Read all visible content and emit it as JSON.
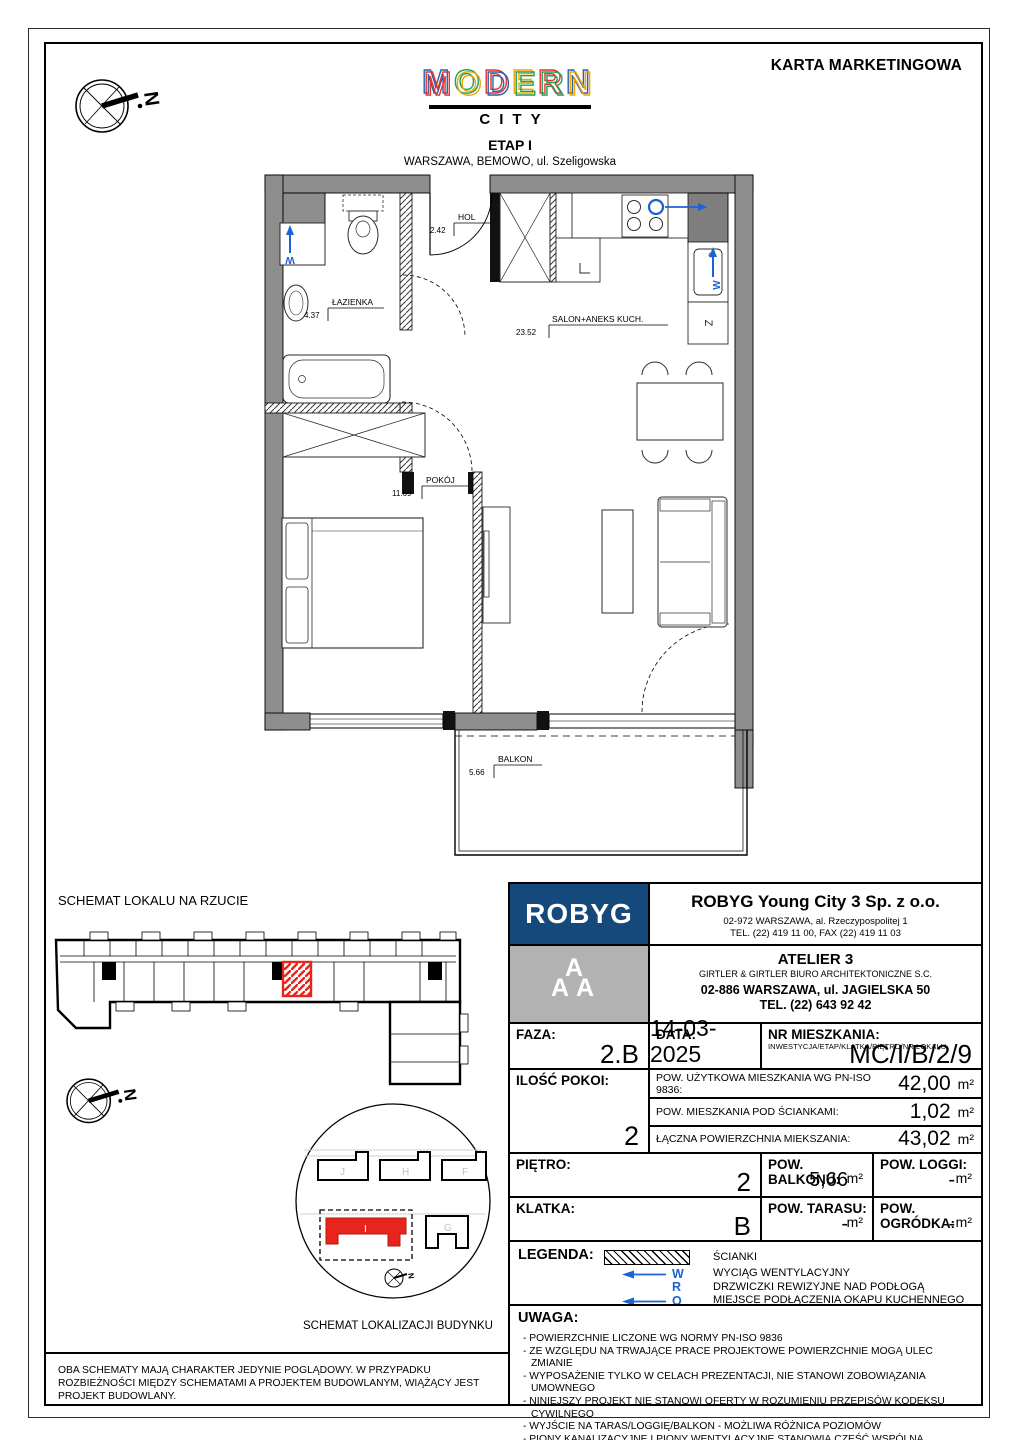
{
  "colors": {
    "navy": "#15497b",
    "atelier_gray": "#b2b2b2",
    "marker_blue": "#1b62d4",
    "highlight_red": "#e8251c",
    "wall_gray": "#8e8e8e"
  },
  "header": {
    "title": "KARTA MARKETINGOWA",
    "logo_letters": [
      "M",
      "O",
      "D",
      "E",
      "R",
      "N"
    ],
    "logo_sub": "CITY",
    "stage": "ETAP I",
    "location": "WARSZAWA, BEMOWO, ul. Szeligowska",
    "north_letter": "N"
  },
  "floor_plan": {
    "rooms": {
      "lazienka": {
        "name": "ŁAZIENKA",
        "area": "4.37"
      },
      "hol": {
        "name": "HOL",
        "area": "2.42"
      },
      "salon": {
        "name": "SALON+ANEKS KUCH.",
        "area": "23.52"
      },
      "pokoj": {
        "name": "POKÓJ",
        "area": "11.69"
      },
      "balkon": {
        "name": "BALKON",
        "area": "5.66"
      }
    },
    "markers": {
      "vent": "W",
      "hood": "O",
      "sink": "Z"
    }
  },
  "schematics": {
    "plan_title": "SCHEMAT LOKALU NA RZUCIE",
    "location_title": "SCHEMAT LOKALIZACJI BUDYNKU",
    "buildings": [
      "J",
      "H",
      "F",
      "I",
      "G"
    ]
  },
  "company": {
    "developer": {
      "logo": "ROBYG",
      "name": "ROBYG Young City 3 Sp. z o.o.",
      "address": "02-972 WARSZAWA, al. Rzeczypospolitej 1",
      "phone": "TEL. (22) 419 11 00, FAX (22) 419 11 03"
    },
    "architect": {
      "logo_letters": [
        "A",
        "A",
        "A"
      ],
      "name": "ATELIER 3",
      "subtitle": "GIRTLER & GIRTLER BIURO ARCHITEKTONICZNE S.C.",
      "address": "02-886 WARSZAWA, ul. JAGIELSKA 50",
      "phone": "TEL. (22) 643 92 42"
    }
  },
  "details": {
    "faza_label": "FAZA:",
    "faza_value": "2.B",
    "data_label": "DATA:",
    "data_value": "14-03-2025",
    "nr_label": "NR MIESZKANIA:",
    "nr_sublabel": "INWESTYCJA/ETAP/KLATKA/PIĘTRO/NR LOKALU",
    "nr_value": "MC/I/B/2/9",
    "rooms_label": "ILOŚĆ POKOI:",
    "rooms_value": "2",
    "areas": [
      {
        "label": "POW. UŻYTKOWA MIESZKANIA WG PN-ISO 9836:",
        "value": "42,00",
        "unit": "m²"
      },
      {
        "label": "POW. MIESZKANIA POD ŚCIANKAMI:",
        "value": "1,02",
        "unit": "m²"
      },
      {
        "label": "ŁĄCZNA POWIERZCHNIA MIEKSZANIA:",
        "value": "43,02",
        "unit": "m²"
      }
    ],
    "pietro_label": "PIĘTRO:",
    "pietro_value": "2",
    "balkon_label": "POW. BALKONU:",
    "balkon_value": "5,66",
    "balkon_unit": "m²",
    "loggia_label": "POW. LOGGI:",
    "loggia_value": "-",
    "loggia_unit": "m²",
    "klatka_label": "KLATKA:",
    "klatka_value": "B",
    "taras_label": "POW. TARASU:",
    "taras_value": "-",
    "taras_unit": "m²",
    "ogrodek_label": "POW. OGRÓDKA:",
    "ogrodek_value": "-",
    "ogrodek_unit": "m²"
  },
  "legend": {
    "label": "LEGENDA:",
    "items": [
      {
        "symbol": "hatch",
        "label": "ŚCIANKI"
      },
      {
        "symbol": "W",
        "label": "WYCIĄG WENTYLACYJNY"
      },
      {
        "symbol": "R",
        "label": "DRZWICZKI REWIZYJNE NAD PODŁOGĄ"
      },
      {
        "symbol": "O",
        "label": "MIEJSCE PODŁĄCZENIA OKAPU KUCHENNEGO"
      }
    ]
  },
  "uwaga": {
    "label": "UWAGA:",
    "items": [
      "- POWIERZCHNIE LICZONE WG NORMY PN-ISO 9836",
      "- ZE WZGLĘDU NA TRWAJĄCE PRACE PROJEKTOWE POWIERZCHNIE MOGĄ ULEC ZMIANIE",
      "- WYPOSAŻENIE TYLKO W CELACH PREZENTACJI, NIE STANOWI ZOBOWIĄZANIA UMOWNEGO",
      "- NINIEJSZY PROJEKT NIE STANOWI OFERTY W ROZUMIENIU PRZEPISÓW KODEKSU CYWILNEGO",
      "- WYJŚCIE NA TARAS/LOGGIĘ/BALKON - MOŻLIWA RÓŻNICA POZIOMÓW",
      "- PIONY KANALIZACYJNE I PIONY WENTYLACYJNE STANOWIĄ CZĘŚĆ WSPÓLNĄ INSTALACJI BUDYNKU",
      "- W PRZYPADKU WYSTĘPOWANIA OTWORU REWIZYJNEGO NA PIONIE MUSI BYĆ ZAPEWNIONY DOSTĘP DO NIEGO ZGODNIE Z DOKUMENTACJĄ TECHNICZNĄ"
    ]
  },
  "disclaimer": "OBA SCHEMATY MAJĄ CHARAKTER JEDYNIE POGLĄDOWY. W PRZYPADKU ROZBIEŻNOŚCI MIĘDZY SCHEMATAMI A PROJEKTEM BUDOWLANYM, WIĄŻĄCY JEST PROJEKT BUDOWLANY."
}
